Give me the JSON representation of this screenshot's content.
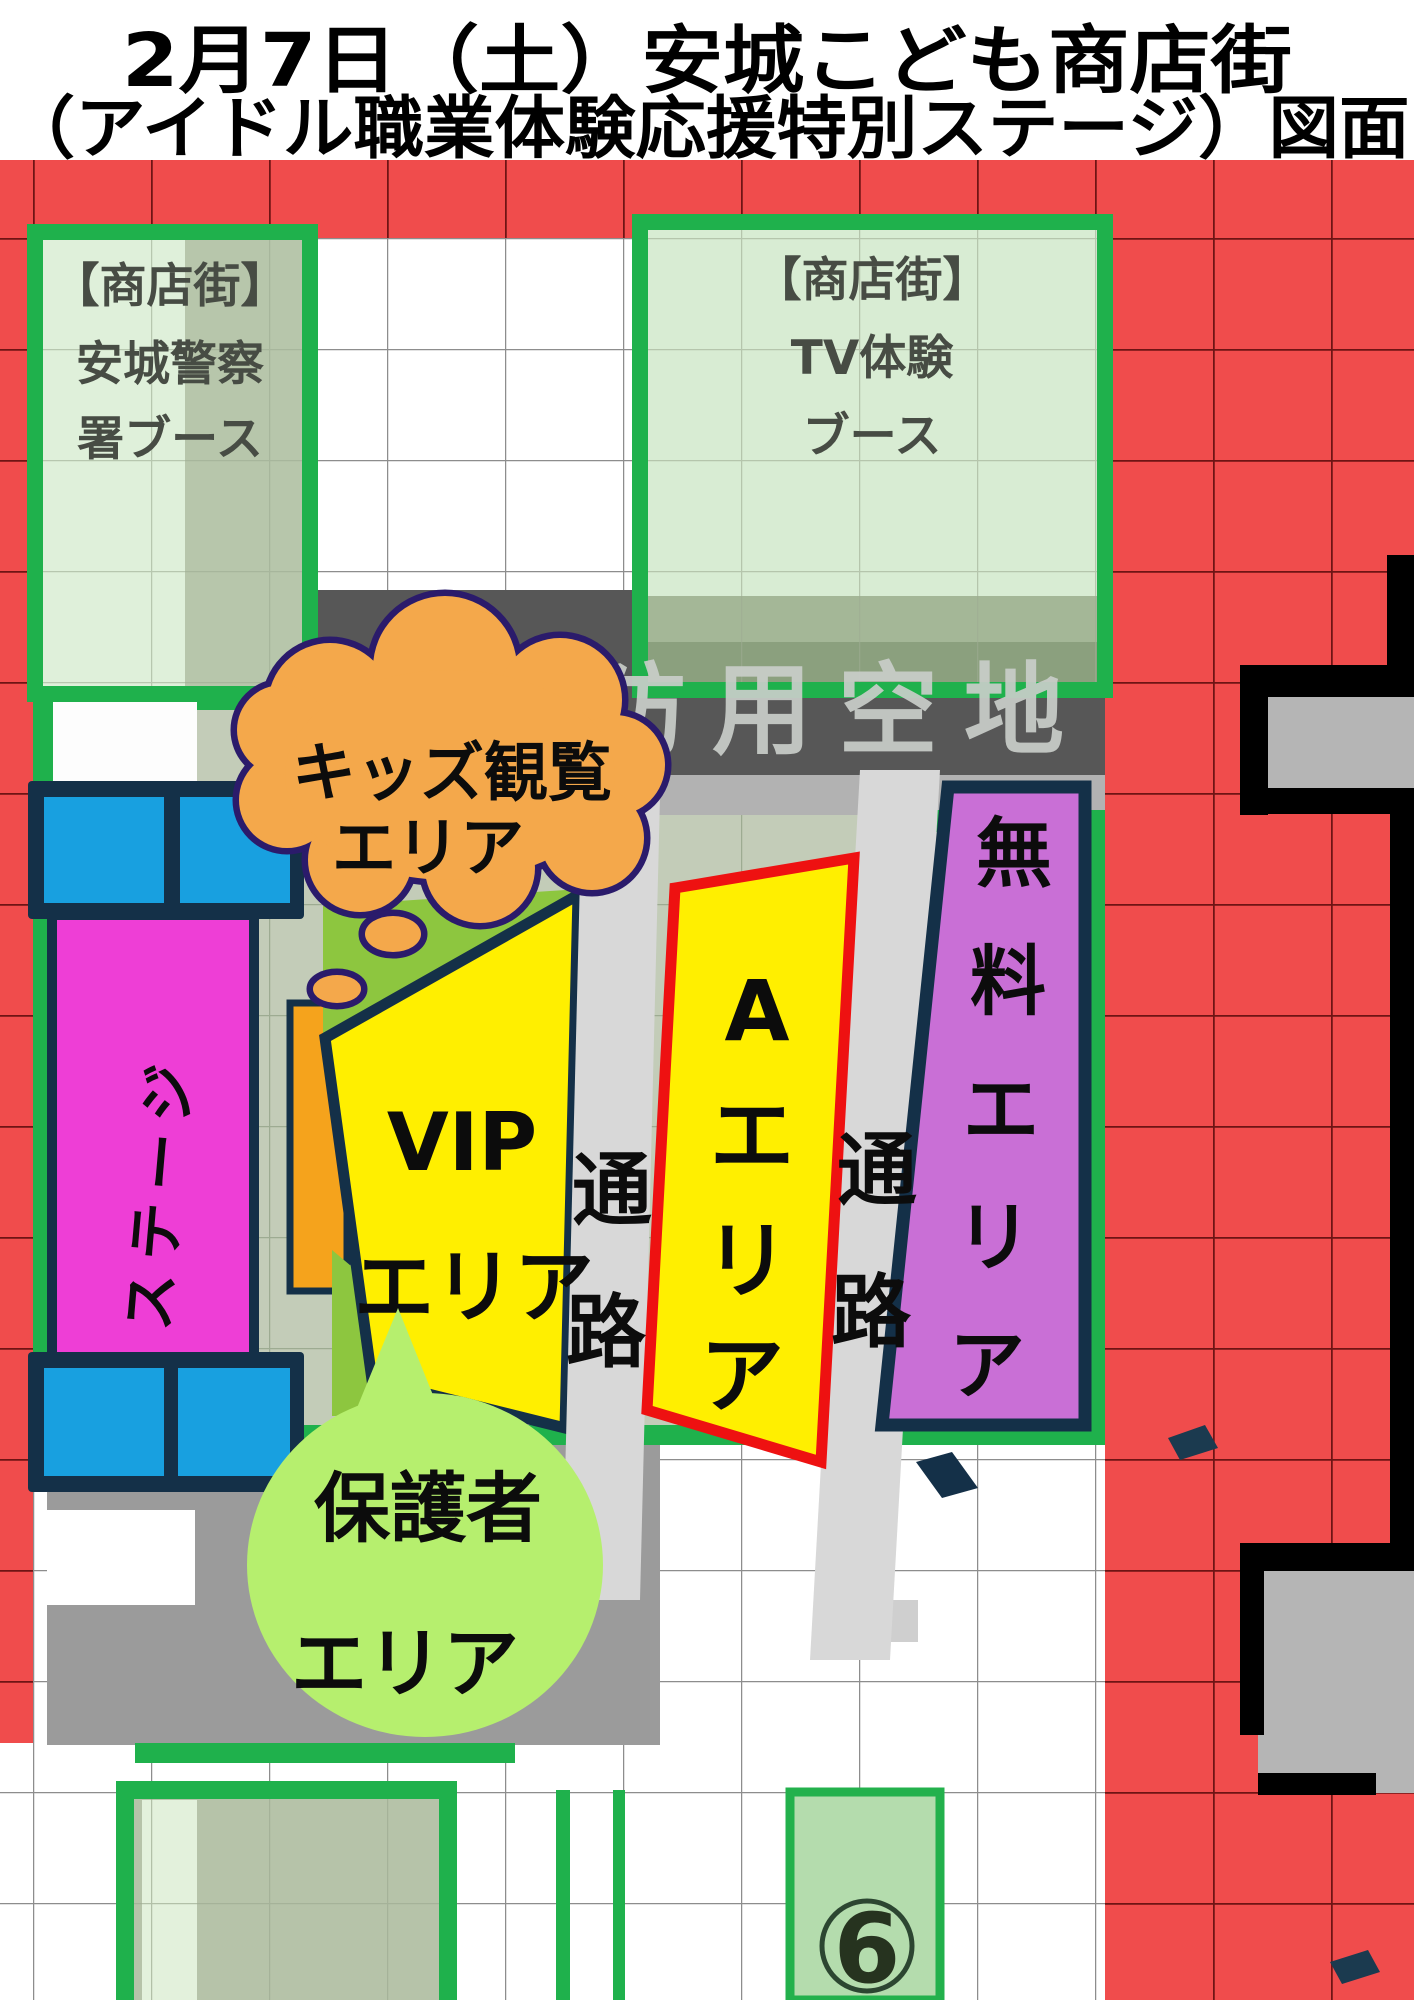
{
  "title": {
    "line1": "2月7日（土）安城こども商店街",
    "line2": "（アイドル職業体験応援特別ステージ）図面"
  },
  "booths": {
    "police": {
      "lines": [
        "【商店街】",
        "安城警察",
        "署ブース"
      ]
    },
    "tv": {
      "lines": [
        "【商店街】",
        "TV体験",
        "ブース"
      ]
    }
  },
  "fire_lane_label": "消防用空地",
  "kids_cloud": {
    "lines": [
      "キッズ観覧",
      "エリア"
    ]
  },
  "stage": {
    "label": "ステージ"
  },
  "vip": {
    "line1": "VIP",
    "line2": "エリア"
  },
  "aisles": {
    "left": {
      "chars": [
        "通",
        "路"
      ]
    },
    "right": {
      "chars": [
        "通",
        "路"
      ]
    }
  },
  "a_area": {
    "chars": [
      "A",
      "エ",
      "リ",
      "ア"
    ]
  },
  "free_area": {
    "chars": [
      "無",
      "料",
      "エ",
      "リ",
      "ア"
    ]
  },
  "guardian": {
    "lines": [
      "保護者",
      "エリア"
    ]
  },
  "marker": {
    "number": "6"
  },
  "colors": {
    "red_grid": "#f04c4c",
    "booth_green": "#1fb14c",
    "booth_fill_light": "#dff0da",
    "booth_fill_sage": "#b7c6ab",
    "seat_yellow": "#ffef00",
    "area_red_border": "#ee1111",
    "free_purple": "#c96fd6",
    "stage_magenta": "#ee3ed6",
    "speaker_blue": "#18a0e0",
    "bar_orange": "#f5a31c",
    "cloud_orange": "#f4a84b",
    "cloud_outline": "#2b1b6b",
    "wedge_green": "#8dc63f",
    "guardian_green": "#b6ef6e",
    "aisle_gray": "#d8d8d8",
    "band_gray": "#575757",
    "navy": "#143048"
  }
}
